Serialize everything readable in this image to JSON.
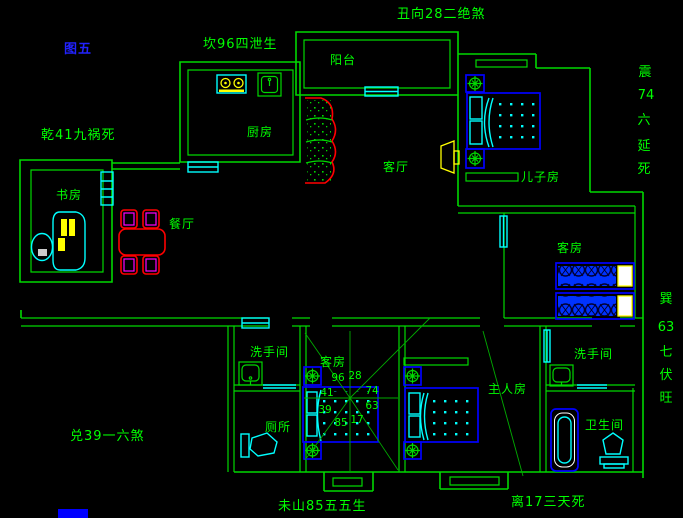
{
  "title": {
    "figure_label": "图五"
  },
  "colors": {
    "bg": "#000000",
    "wall": "#00d800",
    "text": "#00ff00",
    "ray": "#00aa00",
    "blue": "#0000ff",
    "cyan": "#00ffff",
    "yellow": "#ffff00",
    "red": "#ff0000",
    "magenta": "#ff00ff",
    "title-blue": "#2222ff",
    "white": "#ffffff"
  },
  "annotations": {
    "top_left": "坎96四泄生",
    "top_center": "丑向28二绝煞",
    "left_upper": "乾41九祸死",
    "left_lower": "兑39一六煞",
    "bottom_center": "未山85五五生",
    "bottom_right": "离17三天死",
    "right_upper_chars": [
      "震",
      "74",
      "六",
      "延",
      "死"
    ],
    "right_lower_chars": [
      "巽",
      "63",
      "七",
      "伏",
      "旺"
    ]
  },
  "rooms": {
    "balcony": "阳台",
    "kitchen": "厨房",
    "study": "书房",
    "dining": "餐厅",
    "living": "客厅",
    "sons_room": "儿子房",
    "guest_right": "客房",
    "guest_mid": "客房",
    "washroom_left": "洗手间",
    "washroom_right": "洗手间",
    "toilet": "厕所",
    "master": "主人房",
    "bathroom": "卫生间"
  },
  "compass": {
    "numbers": [
      "96",
      "28",
      "41",
      "74",
      "39",
      "63",
      "85",
      "17"
    ]
  }
}
